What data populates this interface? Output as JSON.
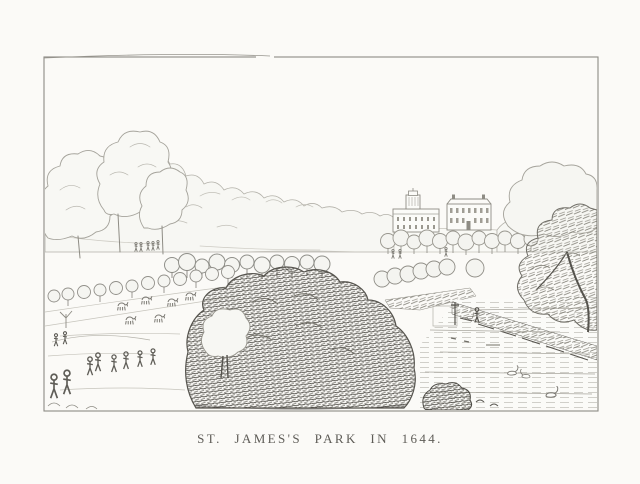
{
  "plate": {
    "caption": "ST. JAMES'S PARK IN 1644.",
    "description": "Monochrome engraved plate: view of St. James's Park in 1644 with open lawns, strolling figures, deer, avenues of young round-topped trees, a large dark clump of trees in the centre foreground, the canal with swans at the right, and palace buildings on the tree-lined skyline, all inside a thin rectangular border.",
    "colors": {
      "paper": "#fbfaf7",
      "ink": "#4c4a45",
      "ink_medium": "#7a786f",
      "ink_light": "#a5a39b",
      "frame": "#8d8b85"
    }
  }
}
